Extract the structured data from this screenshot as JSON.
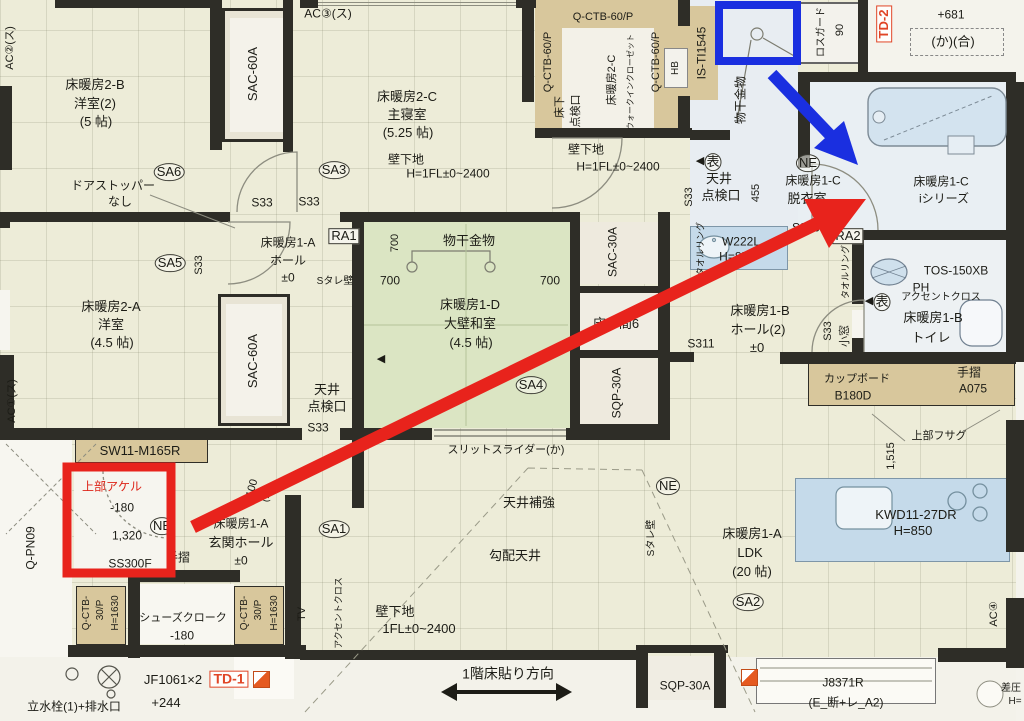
{
  "colors": {
    "paper": "#edecd8",
    "wall": "#2e2d27",
    "tatami_green": "#dbe5c3",
    "cabinet_tan": "#d8c79c",
    "fixture_blue": "#c5daea",
    "wet_floor": "#e8edf2",
    "annotation_red": "#e8231c",
    "annotation_blue": "#1a2fe0",
    "detail_red": "#e04526"
  },
  "annotations": {
    "red_rectangle": {
      "color": "#e8231c"
    },
    "blue_rectangle": {
      "color": "#1a2fe0"
    },
    "red_arrow": {
      "color": "#e8231c"
    },
    "blue_arrow": {
      "color": "#1a2fe0"
    }
  },
  "labels": [
    {
      "n": "ac2-label",
      "t": "AC②(ス)",
      "x": 11,
      "y": 48,
      "r": -90,
      "s": 11
    },
    {
      "n": "room-2b-name",
      "t": "床暖房2-B",
      "x": 95,
      "y": 85
    },
    {
      "n": "room-2b-type",
      "t": "洋室(2)",
      "x": 95,
      "y": 104
    },
    {
      "n": "room-2b-size",
      "t": "(5 帖)",
      "x": 96,
      "y": 122
    },
    {
      "n": "sac-60a-top",
      "t": "SAC-60A",
      "x": 253,
      "y": 74,
      "r": -90
    },
    {
      "n": "ac3-label",
      "t": "AC③(ス)",
      "x": 328,
      "y": 14,
      "s": 12
    },
    {
      "n": "doorstopper-1",
      "t": "ドアストッパー",
      "x": 113,
      "y": 186,
      "s": 12
    },
    {
      "n": "doorstopper-2",
      "t": "なし",
      "x": 120,
      "y": 202,
      "s": 12
    },
    {
      "n": "sa6-mark",
      "t": "SA6",
      "x": 169,
      "y": 172,
      "k": "circ"
    },
    {
      "n": "s33-1",
      "t": "S33",
      "x": 262,
      "y": 203,
      "s": 12
    },
    {
      "n": "s33-2",
      "t": "S33",
      "x": 309,
      "y": 202,
      "s": 12
    },
    {
      "n": "sa3-mark",
      "t": "SA3",
      "x": 334,
      "y": 170,
      "k": "circ"
    },
    {
      "n": "room-2c-name",
      "t": "床暖房2-C",
      "x": 407,
      "y": 97
    },
    {
      "n": "room-2c-type",
      "t": "主寝室",
      "x": 407,
      "y": 115
    },
    {
      "n": "room-2c-size",
      "t": "(5.25 帖)",
      "x": 408,
      "y": 133
    },
    {
      "n": "kabeshitaji-1a",
      "t": "壁下地",
      "x": 406,
      "y": 160,
      "s": 12
    },
    {
      "n": "kabeshitaji-1b",
      "t": "H=1FL±0~2400",
      "x": 448,
      "y": 174,
      "s": 12
    },
    {
      "n": "q-ctb-60p-1",
      "t": "Q-CTB-60/P",
      "x": 549,
      "y": 62,
      "r": -90,
      "s": 11
    },
    {
      "n": "q-ctb-60p-2",
      "t": "Q-CTB-60/P",
      "x": 603,
      "y": 18,
      "s": 11
    },
    {
      "n": "q-ctb-60p-3",
      "t": "Q-CTB-60/P",
      "x": 657,
      "y": 62,
      "r": -90,
      "s": 11
    },
    {
      "n": "hb-label",
      "t": "HB",
      "x": 676,
      "y": 68,
      "r": -90,
      "s": 10
    },
    {
      "n": "yukashita-1",
      "t": "床下",
      "x": 561,
      "y": 107,
      "r": -90,
      "s": 11
    },
    {
      "n": "yukashita-2",
      "t": "点検口",
      "x": 577,
      "y": 111,
      "r": -90,
      "s": 11
    },
    {
      "n": "wic-name-1",
      "t": "床暖房2-C",
      "x": 613,
      "y": 80,
      "r": -90,
      "s": 11
    },
    {
      "n": "wic-name-2",
      "t": "ウォークインクローゼット",
      "x": 631,
      "y": 82,
      "r": -90,
      "s": 8
    },
    {
      "n": "is-ti1545",
      "t": "IS-TI1545",
      "x": 702,
      "y": 53,
      "r": -90,
      "s": 12
    },
    {
      "n": "monohoshi-v",
      "t": "物干金物",
      "x": 741,
      "y": 100,
      "r": -90,
      "s": 12
    },
    {
      "n": "rosguard-1",
      "t": "ロスガード",
      "x": 822,
      "y": 32,
      "r": -90,
      "s": 10
    },
    {
      "n": "rosguard-2",
      "t": "90",
      "x": 841,
      "y": 30,
      "r": -90,
      "s": 11
    },
    {
      "n": "td-2",
      "t": "TD-2",
      "x": 884,
      "y": 24,
      "r": -90,
      "s": 13,
      "k": "rbox"
    },
    {
      "n": "dim-681",
      "t": "+681",
      "x": 951,
      "y": 15,
      "s": 12
    },
    {
      "n": "ka-gou",
      "t": "(か)(合)",
      "x": 953,
      "y": 42,
      "s": 13
    },
    {
      "n": "kabeshitaji-2a",
      "t": "壁下地",
      "x": 586,
      "y": 150,
      "s": 12
    },
    {
      "n": "kabeshitaji-2b",
      "t": "H=1FL±0~2400",
      "x": 618,
      "y": 167,
      "s": 12
    },
    {
      "n": "s33-3",
      "t": "S33",
      "x": 690,
      "y": 197,
      "r": -90,
      "s": 11
    },
    {
      "n": "tenjo-tenkenko-1a",
      "t": "天井",
      "x": 719,
      "y": 179
    },
    {
      "n": "tenjo-tenkenko-1b",
      "t": "点検口",
      "x": 721,
      "y": 196
    },
    {
      "n": "dim-455",
      "t": "455",
      "x": 757,
      "y": 193,
      "r": -90,
      "s": 11
    },
    {
      "n": "ne-1",
      "t": "NE",
      "x": 808,
      "y": 163,
      "k": "circ"
    },
    {
      "n": "datsuishitsu-1",
      "t": "床暖房1-C",
      "x": 813,
      "y": 181,
      "s": 12
    },
    {
      "n": "datsuishitsu-2",
      "t": "脱衣室",
      "x": 807,
      "y": 199
    },
    {
      "n": "bathroom-1",
      "t": "床暖房1-C",
      "x": 941,
      "y": 182,
      "s": 12
    },
    {
      "n": "bathroom-2",
      "t": "iシリーズ",
      "x": 944,
      "y": 199,
      "s": 12
    },
    {
      "n": "s300",
      "t": "S300",
      "x": 806,
      "y": 228,
      "s": 12
    },
    {
      "n": "ra2",
      "t": "RA2",
      "x": 848,
      "y": 236,
      "k": "box"
    },
    {
      "n": "towel-ring-1",
      "t": "タオルリング",
      "x": 701,
      "y": 249,
      "r": -90,
      "s": 9
    },
    {
      "n": "towel-ring-2",
      "t": "タオルリング",
      "x": 846,
      "y": 272,
      "r": -90,
      "s": 9
    },
    {
      "n": "w222l-1",
      "t": "W222L",
      "x": 741,
      "y": 242,
      "s": 12
    },
    {
      "n": "w222l-2",
      "t": "H=850",
      "x": 737,
      "y": 257,
      "s": 12
    },
    {
      "n": "hall-1b-1",
      "t": "床暖房1-B",
      "x": 760,
      "y": 311
    },
    {
      "n": "hall-1b-2",
      "t": "ホール(2)",
      "x": 758,
      "y": 330
    },
    {
      "n": "hall-1b-3",
      "t": "±0",
      "x": 757,
      "y": 348
    },
    {
      "n": "s311",
      "t": "S311",
      "x": 701,
      "y": 344,
      "s": 12
    },
    {
      "n": "s33-4",
      "t": "S33",
      "x": 829,
      "y": 331,
      "r": -90,
      "s": 11
    },
    {
      "n": "komado",
      "t": "小窓",
      "x": 846,
      "y": 336,
      "r": -90,
      "s": 11
    },
    {
      "n": "tos-150xb",
      "t": "TOS-150XB",
      "x": 956,
      "y": 271,
      "s": 12
    },
    {
      "n": "ph-label",
      "t": "PH",
      "x": 921,
      "y": 288,
      "s": 12
    },
    {
      "n": "accent-cloth-1",
      "t": "アクセントクロス",
      "x": 941,
      "y": 298,
      "s": 10
    },
    {
      "n": "toilet-1",
      "t": "床暖房1-B",
      "x": 933,
      "y": 318
    },
    {
      "n": "toilet-2",
      "t": "トイレ",
      "x": 931,
      "y": 338
    },
    {
      "n": "tesuri-a075-1",
      "t": "手摺",
      "x": 969,
      "y": 373,
      "s": 12
    },
    {
      "n": "tesuri-a075-2",
      "t": "A075",
      "x": 973,
      "y": 389,
      "s": 12
    },
    {
      "n": "cupboard-1",
      "t": "カップボード",
      "x": 857,
      "y": 380,
      "s": 11
    },
    {
      "n": "cupboard-2",
      "t": "B180D",
      "x": 853,
      "y": 396,
      "s": 12
    },
    {
      "n": "joubu-fusagu",
      "t": "上部フサグ",
      "x": 939,
      "y": 437,
      "s": 11
    },
    {
      "n": "dim-1515",
      "t": "1,515",
      "x": 892,
      "y": 456,
      "r": -90,
      "s": 11
    },
    {
      "n": "kwd-1",
      "t": "KWD11-27DR",
      "x": 916,
      "y": 515
    },
    {
      "n": "kwd-2",
      "t": "H=850",
      "x": 913,
      "y": 531
    },
    {
      "n": "ldk-1",
      "t": "床暖房1-A",
      "x": 752,
      "y": 534
    },
    {
      "n": "ldk-2",
      "t": "LDK",
      "x": 750,
      "y": 553
    },
    {
      "n": "ldk-3",
      "t": "(20 帖)",
      "x": 752,
      "y": 572
    },
    {
      "n": "ne-2",
      "t": "NE",
      "x": 668,
      "y": 486,
      "k": "circ"
    },
    {
      "n": "stare-kabe-2",
      "t": "Sタレ壁",
      "x": 652,
      "y": 538,
      "r": -90,
      "s": 10
    },
    {
      "n": "sa2-mark",
      "t": "SA2",
      "x": 748,
      "y": 602,
      "k": "circ"
    },
    {
      "n": "ac4-label",
      "t": "AC④",
      "x": 995,
      "y": 614,
      "r": -90,
      "s": 11
    },
    {
      "n": "sac-30a",
      "t": "SAC-30A",
      "x": 613,
      "y": 252,
      "r": -90,
      "s": 12
    },
    {
      "n": "tokonoma",
      "t": "床の間6",
      "x": 616,
      "y": 324
    },
    {
      "n": "sqp-30a-1",
      "t": "SQP-30A",
      "x": 617,
      "y": 393,
      "r": -90,
      "s": 12
    },
    {
      "n": "monohoshi-h",
      "t": "物干金物",
      "x": 469,
      "y": 241
    },
    {
      "n": "dim-700a",
      "t": "700",
      "x": 396,
      "y": 243,
      "r": -90,
      "s": 11
    },
    {
      "n": "dim-700b",
      "t": "700",
      "x": 390,
      "y": 281,
      "s": 12
    },
    {
      "n": "dim-700c",
      "t": "700",
      "x": 550,
      "y": 281,
      "s": 12
    },
    {
      "n": "washitsu-1",
      "t": "床暖房1-D",
      "x": 470,
      "y": 305
    },
    {
      "n": "washitsu-2",
      "t": "大壁和室",
      "x": 470,
      "y": 324
    },
    {
      "n": "washitsu-3",
      "t": "(4.5 帖)",
      "x": 471,
      "y": 343
    },
    {
      "n": "sa4-mark",
      "t": "SA4",
      "x": 531,
      "y": 385,
      "k": "circ"
    },
    {
      "n": "hall-1a-1",
      "t": "床暖房1-A",
      "x": 288,
      "y": 243,
      "s": 12
    },
    {
      "n": "hall-1a-2",
      "t": "ホール",
      "x": 288,
      "y": 261,
      "s": 12
    },
    {
      "n": "hall-1a-3",
      "t": "±0",
      "x": 288,
      "y": 278,
      "s": 12
    },
    {
      "n": "ra1",
      "t": "RA1",
      "x": 344,
      "y": 236,
      "k": "box"
    },
    {
      "n": "stare-kabe-1",
      "t": "Sタレ壁",
      "x": 335,
      "y": 282,
      "s": 10
    },
    {
      "n": "sa5-mark",
      "t": "SA5",
      "x": 170,
      "y": 263,
      "k": "circ"
    },
    {
      "n": "s33-5",
      "t": "S33",
      "x": 200,
      "y": 265,
      "r": -90,
      "s": 11
    },
    {
      "n": "room-2a-1",
      "t": "床暖房2-A",
      "x": 111,
      "y": 307
    },
    {
      "n": "room-2a-2",
      "t": "洋室",
      "x": 111,
      "y": 325
    },
    {
      "n": "room-2a-3",
      "t": "(4.5 帖)",
      "x": 112,
      "y": 343
    },
    {
      "n": "sac-60a-left",
      "t": "SAC-60A",
      "x": 253,
      "y": 361,
      "r": -90
    },
    {
      "n": "tenjo-tenkenko-2a",
      "t": "天井",
      "x": 327,
      "y": 390
    },
    {
      "n": "tenjo-tenkenko-2b",
      "t": "点検口",
      "x": 327,
      "y": 407
    },
    {
      "n": "s33-6",
      "t": "S33",
      "x": 318,
      "y": 428,
      "s": 12
    },
    {
      "n": "ac1-label",
      "t": "AC①(ス)",
      "x": 13,
      "y": 401,
      "r": -90,
      "s": 11
    },
    {
      "n": "sw11-m165r",
      "t": "SW11-M165R",
      "x": 140,
      "y": 451
    },
    {
      "n": "joubu-akeru",
      "t": "上部アケル",
      "x": 112,
      "y": 487,
      "s": 12,
      "c": "red"
    },
    {
      "n": "dim-m180a",
      "t": "-180",
      "x": 122,
      "y": 508,
      "s": 12
    },
    {
      "n": "dim-1320",
      "t": "1,320",
      "x": 127,
      "y": 536,
      "s": 12
    },
    {
      "n": "ne-3",
      "t": "NE",
      "x": 162,
      "y": 526,
      "k": "circ"
    },
    {
      "n": "ss300f",
      "t": "SS300F",
      "x": 130,
      "y": 564,
      "s": 12
    },
    {
      "n": "tesuri-2",
      "t": "手摺",
      "x": 178,
      "y": 558,
      "s": 12
    },
    {
      "n": "genkan-1",
      "t": "床暖房1-A",
      "x": 241,
      "y": 524,
      "s": 12
    },
    {
      "n": "genkan-2",
      "t": "玄関ホール",
      "x": 241,
      "y": 543
    },
    {
      "n": "genkan-3",
      "t": "±0",
      "x": 241,
      "y": 561,
      "s": 12
    },
    {
      "n": "s100",
      "t": "S100",
      "x": 252,
      "y": 492,
      "r": -75,
      "s": 11
    },
    {
      "n": "ka-v",
      "t": "(か)",
      "x": 268,
      "y": 494,
      "r": -75,
      "s": 10
    },
    {
      "n": "q-pn09",
      "t": "Q-PN09",
      "x": 31,
      "y": 548,
      "r": -90,
      "s": 12
    },
    {
      "n": "q-ctb-30p-l1",
      "t": "Q-CTB-",
      "x": 87,
      "y": 613,
      "r": -90,
      "s": 10
    },
    {
      "n": "q-ctb-30p-l2",
      "t": "30/P",
      "x": 101,
      "y": 610,
      "r": -90,
      "s": 10
    },
    {
      "n": "q-ctb-30p-l3",
      "t": "H=1630",
      "x": 116,
      "y": 613,
      "r": -90,
      "s": 10
    },
    {
      "n": "shoes-closet-1",
      "t": "シューズクローク",
      "x": 183,
      "y": 619,
      "s": 11
    },
    {
      "n": "shoes-closet-2",
      "t": "-180",
      "x": 182,
      "y": 636,
      "s": 12
    },
    {
      "n": "q-ctb-30p-r1",
      "t": "Q-CTB-",
      "x": 245,
      "y": 613,
      "r": -90,
      "s": 10
    },
    {
      "n": "q-ctb-30p-r2",
      "t": "30/P",
      "x": 259,
      "y": 610,
      "r": -90,
      "s": 10
    },
    {
      "n": "q-ctb-30p-r3",
      "t": "H=1630",
      "x": 275,
      "y": 613,
      "r": -90,
      "s": 10
    },
    {
      "n": "jf1061",
      "t": "JF1061×2",
      "x": 173,
      "y": 680
    },
    {
      "n": "td-1",
      "t": "TD-1",
      "x": 229,
      "y": 679,
      "s": 14,
      "k": "rbox"
    },
    {
      "n": "dim-244",
      "t": "+244",
      "x": 166,
      "y": 703
    },
    {
      "n": "tatemizusen",
      "t": "立水栓(1)+排水口",
      "x": 74,
      "y": 707,
      "s": 12
    },
    {
      "n": "slit-slider",
      "t": "スリットスライダー(か)",
      "x": 506,
      "y": 451,
      "s": 11
    },
    {
      "n": "tenjo-hokyo",
      "t": "天井補強",
      "x": 529,
      "y": 503
    },
    {
      "n": "koubai-tenjo",
      "t": "勾配天井",
      "x": 515,
      "y": 556
    },
    {
      "n": "kabeshitaji-3a",
      "t": "壁下地",
      "x": 395,
      "y": 612
    },
    {
      "n": "kabeshitaji-3b",
      "t": "1FL±0~2400",
      "x": 419,
      "y": 629
    },
    {
      "n": "floor-direction",
      "t": "1階床貼り方向",
      "x": 508,
      "y": 674,
      "s": 14
    },
    {
      "n": "sa1-mark",
      "t": "SA1",
      "x": 334,
      "y": 529,
      "k": "circ"
    },
    {
      "n": "tv-label",
      "t": "TV",
      "x": 303,
      "y": 614,
      "r": -90,
      "s": 11
    },
    {
      "n": "accent-cloth-2",
      "t": "アクセントクロス",
      "x": 339,
      "y": 613,
      "r": -90,
      "s": 9
    },
    {
      "n": "sqp-30a-2",
      "t": "SQP-30A",
      "x": 685,
      "y": 686,
      "s": 12
    },
    {
      "n": "j8371r-1",
      "t": "J8371R",
      "x": 843,
      "y": 683,
      "s": 12
    },
    {
      "n": "j8371r-2",
      "t": "(E_断+レ_A2)",
      "x": 846,
      "y": 703,
      "s": 12
    },
    {
      "n": "sa-atsu",
      "t": "差圧",
      "x": 1011,
      "y": 689,
      "s": 10
    },
    {
      "n": "h-eq",
      "t": "H=",
      "x": 1015,
      "y": 702,
      "s": 10
    },
    {
      "n": "omote-arrow-1",
      "t": "◀",
      "x": 700,
      "y": 162,
      "s": 11
    },
    {
      "n": "omote-mark-1",
      "t": "表",
      "x": 713,
      "y": 162,
      "k": "circ2"
    },
    {
      "n": "omote-arrow-2",
      "t": "◀",
      "x": 869,
      "y": 302,
      "s": 11
    },
    {
      "n": "omote-mark-2",
      "t": "表",
      "x": 882,
      "y": 302,
      "k": "circ2"
    },
    {
      "n": "omote-arrow-3",
      "t": "◀",
      "x": 381,
      "y": 360,
      "s": 11
    }
  ]
}
